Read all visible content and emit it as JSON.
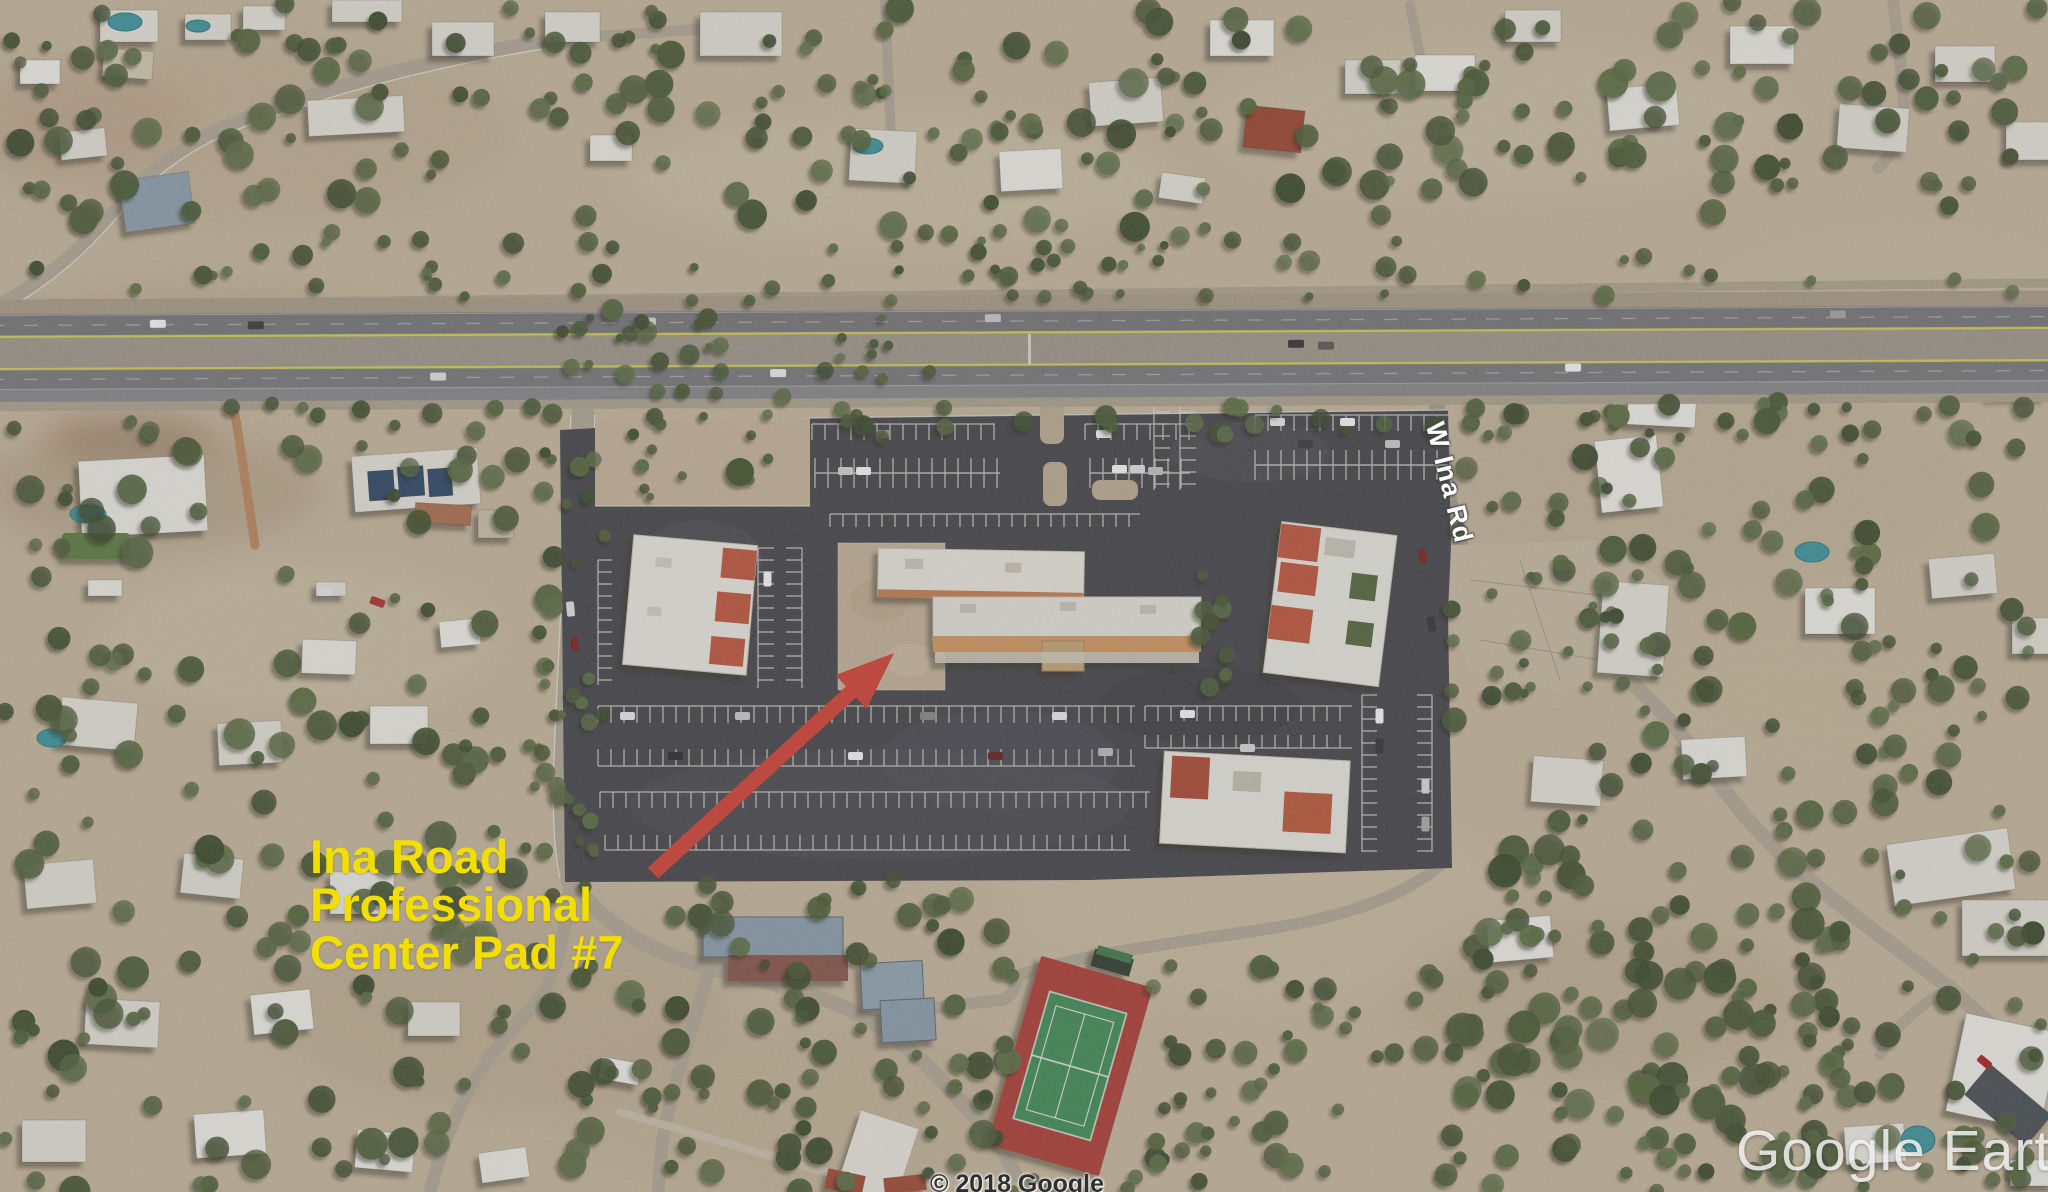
{
  "map_overlay": {
    "site_label": {
      "line1": "Ina Road",
      "line2": "Professional",
      "line3": "Center Pad #7",
      "color": "#f2de00"
    },
    "road_label": {
      "text": "W Ina Rd"
    },
    "watermark": {
      "text": "Google Earth"
    },
    "attribution": {
      "text": "© 2018 Google"
    },
    "arrow": {
      "color": "#bc4a41"
    }
  },
  "colors": {
    "desert": "#cbbba1",
    "plaza_asphalt": "#46464b",
    "highway_asphalt": "#78787c",
    "yellow_line": "#d9d455",
    "tree_green": "#4d5e38",
    "roof_white": "#f1eee6",
    "roof_terracotta": "#c4573a",
    "pool_teal": "#3e98a2",
    "court_red": "#b23c35",
    "court_green": "#3f8f58"
  }
}
